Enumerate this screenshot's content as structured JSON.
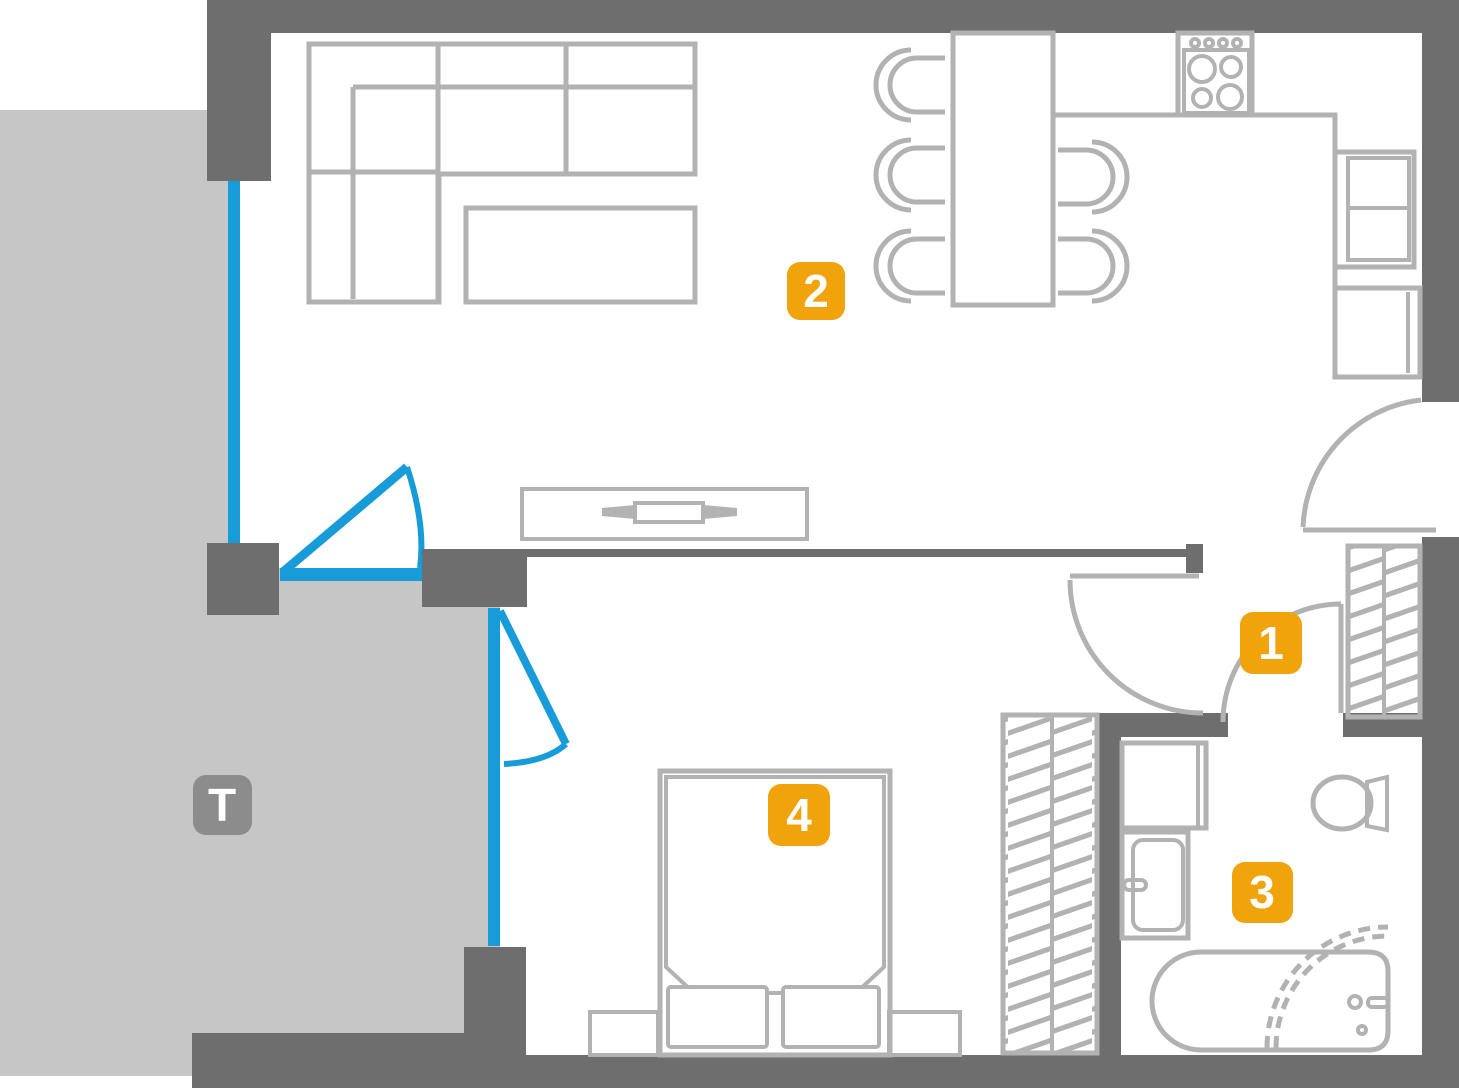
{
  "floor_plan": {
    "labels": {
      "room1": "1",
      "room2": "2",
      "room3": "3",
      "room4": "4",
      "terrace": "T"
    },
    "colors": {
      "background": "#ffffff",
      "wall": "#6e6e6e",
      "furniture_outline": "#b2b2b2",
      "terrace_fill": "#c6c6c6",
      "glazing_blue": "#189cd9",
      "room_badge": "#f0a30b",
      "terrace_badge": "#8c8c8c",
      "badge_text": "#ffffff"
    }
  }
}
